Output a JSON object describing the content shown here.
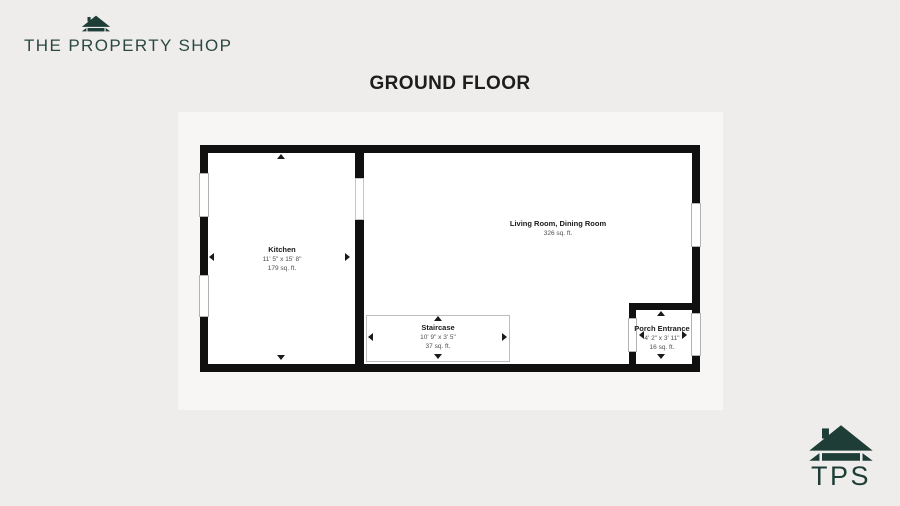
{
  "brand": {
    "name": "THE PROPERTY SHOP",
    "monogram": "TPS",
    "accent_color": "#1e3d37"
  },
  "floor": {
    "title": "GROUND FLOOR"
  },
  "rooms": [
    {
      "name": "Kitchen",
      "dimensions": "11' 5\" x 15' 8\"",
      "area": "179 sq. ft."
    },
    {
      "name": "Living Room, Dining Room",
      "area": "326 sq. ft."
    },
    {
      "name": "Staircase",
      "dimensions": "10' 9\" x 3' 5\"",
      "area": "37 sq. ft."
    },
    {
      "name": "Porch Entrance",
      "dimensions": "4' 2\" x 3' 11\"",
      "area": "16 sq. ft."
    }
  ],
  "icons": {
    "house": "house-icon"
  },
  "colors": {
    "wall": "#101010",
    "room_fill": "#ffffff",
    "page_bg": "#eeedeb",
    "plan_bg": "#f7f6f4"
  }
}
